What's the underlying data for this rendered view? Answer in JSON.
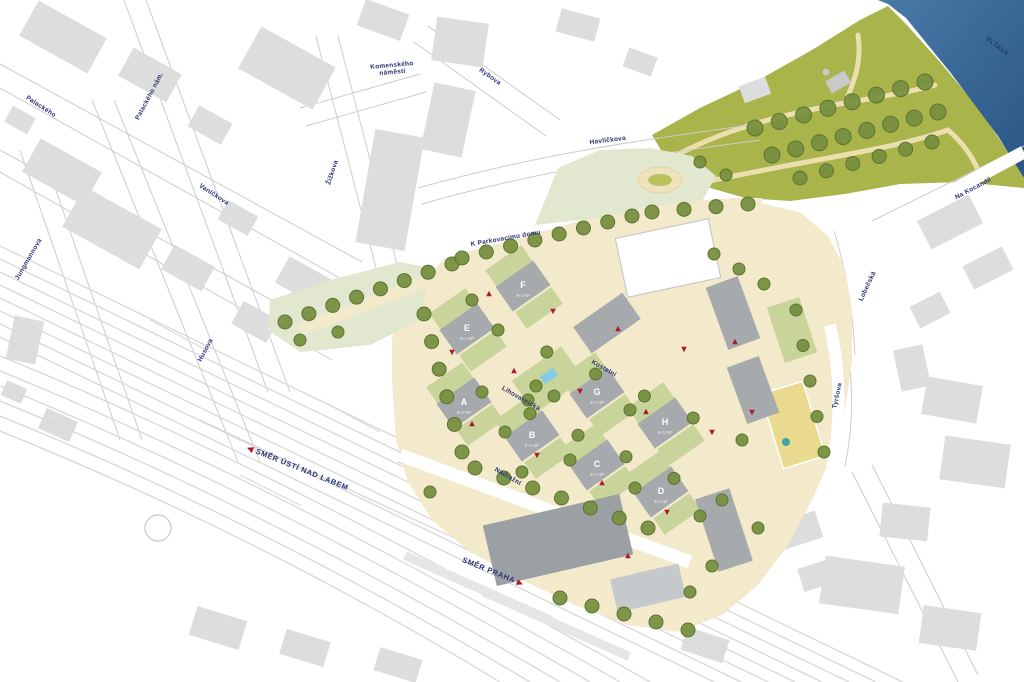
{
  "map": {
    "river": {
      "label": "VLTAVA"
    },
    "streets": [
      {
        "name": "Palackého"
      },
      {
        "name": "Palackého nám."
      },
      {
        "name": "Jungmannova"
      },
      {
        "name": "Vaníčkova"
      },
      {
        "name": "Husova"
      },
      {
        "name": "Žižkova"
      },
      {
        "name": "Komenského náměstí"
      },
      {
        "name": "Rybova"
      },
      {
        "name": "Havlíčkova"
      },
      {
        "name": "K Parkovacímu domu"
      },
      {
        "name": "Na Kocandě"
      },
      {
        "name": "Lobečská"
      },
      {
        "name": "Tyršova"
      },
      {
        "name": "Kostelní"
      },
      {
        "name": "Lihovarnická"
      },
      {
        "name": "Nádražní"
      }
    ],
    "buildings": [
      {
        "id": "A",
        "floors": "8+1 NP"
      },
      {
        "id": "B",
        "floors": "8+1 NP"
      },
      {
        "id": "C",
        "floors": "8+1 NP"
      },
      {
        "id": "D",
        "floors": "8+1 NP"
      },
      {
        "id": "E",
        "floors": "8+1 NP"
      },
      {
        "id": "F",
        "floors": "8+1 NP"
      },
      {
        "id": "G",
        "floors": "8+1 NP"
      },
      {
        "id": "H",
        "floors": "8+1 NP"
      }
    ],
    "directions": [
      {
        "label": "SMĚR ÚSTÍ NAD LABEM",
        "arrow": "left"
      },
      {
        "label": "SMĚR PRAHA",
        "arrow": "right"
      }
    ],
    "colors": {
      "river": "#4a7aa8",
      "river_dark": "#2a5684",
      "park": "#a9b44b",
      "site_paving": "#f3e9cb",
      "lawn": "#c8d49a",
      "pale_green": "#e2e8d0",
      "tree": "#77903f",
      "tree_stroke": "#5d7334",
      "building_site": "#a6aaad",
      "building_context": "#dcdddd",
      "station": "#9aa0a4",
      "label": "#2a3272",
      "marker": "#b2182b",
      "path": "#ecdfae",
      "road_edge": "#cccccc",
      "rail": "#d8d8d8",
      "pool": "#85cbe4",
      "court": "#e9da8f",
      "court_accent": "#3aa6a0"
    }
  }
}
